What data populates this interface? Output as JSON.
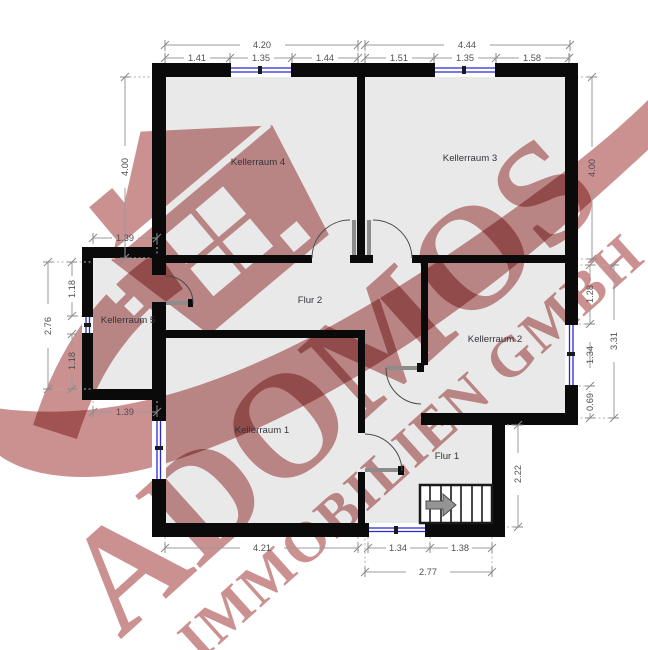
{
  "watermark": {
    "brand": "ADOMOS",
    "subtitle": "IMMOBILIEN GMBH",
    "color": "#ca9190"
  },
  "colors": {
    "wall": "#0a0a0a",
    "floor": "#eae9e9",
    "window_blue": "#2828d8",
    "dimension_line": "#9b9b9b",
    "dimension_text": "#4f4f4f"
  },
  "rooms": {
    "k4": "Kellerraum 4",
    "k3": "Kellerraum 3",
    "k5": "Kellerraum 5",
    "k2": "Kellerraum 2",
    "k1": "Kellerraum 1",
    "flur2": "Flur 2",
    "flur1": "Flur 1"
  },
  "dimensions": {
    "top_left_total": "4.20",
    "top_left_a": "1.41",
    "top_left_b": "1.35",
    "top_left_c": "1.44",
    "top_right_total": "4.44",
    "top_right_a": "1.51",
    "top_right_b": "1.35",
    "top_right_c": "1.58",
    "left_k4_height": "4.00",
    "left_step_top": "1.39",
    "left_k5_total": "2.76",
    "left_k5_a": "1.18",
    "left_k5_b": "1.18",
    "left_step_bottom": "1.39",
    "right_k3_height": "4.00",
    "right_k2_a": "1.28",
    "right_k2_window": "1.34",
    "right_k2_b": "0.69",
    "right_k2_total": "3.31",
    "flur1_height": "2.22",
    "bottom_k1": "4.21",
    "bottom_window": "1.34",
    "bottom_stairs": "1.38",
    "bottom_right_total": "2.77"
  }
}
